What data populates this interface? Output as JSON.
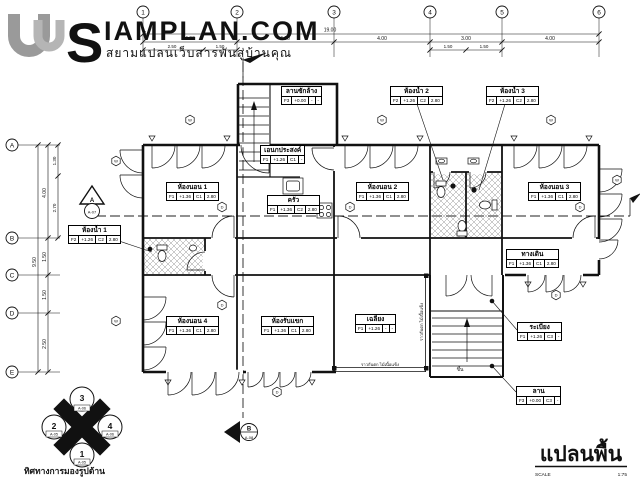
{
  "logo": {
    "brand_s": "S",
    "brand_rest": "IAMPLAN.COM",
    "tagline": "สยามแปลนเว็บสารพันสู่บ้านคุณ"
  },
  "grid": {
    "top": [
      "1",
      "2",
      "3",
      "4",
      "5",
      "6"
    ],
    "left": [
      "A",
      "B",
      "C",
      "D",
      "E"
    ]
  },
  "dimensions": {
    "top_total": "19.00",
    "top_segments": [
      "4.00",
      "4.00",
      "4.00",
      "3.00",
      "4.00"
    ],
    "top_sub_left": [
      "2.50",
      "1.50"
    ],
    "top_sub_mid": [
      "1.50",
      "1.50"
    ],
    "left_total": "9.50",
    "left_segments": [
      "4.00",
      "1.50",
      "1.50",
      "2.50"
    ],
    "left_sub": [
      "1.30",
      "2.70"
    ]
  },
  "rooms": {
    "bedroom1": {
      "name": "ห้องนอน 1",
      "floor": "F1",
      "level": "+1.36",
      "ceiling": "C1",
      "height": "2.80"
    },
    "bedroom2": {
      "name": "ห้องนอน 2",
      "floor": "F1",
      "level": "+1.36",
      "ceiling": "C1",
      "height": "2.80"
    },
    "bedroom3": {
      "name": "ห้องนอน 3",
      "floor": "F1",
      "level": "+1.36",
      "ceiling": "C1",
      "height": "2.80"
    },
    "bedroom4": {
      "name": "ห้องนอน 4",
      "floor": "F1",
      "level": "+1.36",
      "ceiling": "C1",
      "height": "2.80"
    },
    "bathroom1": {
      "name": "ห้องน้ำ 1",
      "floor": "F2",
      "level": "+1.26",
      "ceiling": "C2",
      "height": "2.80"
    },
    "bathroom2": {
      "name": "ห้องน้ำ 2",
      "floor": "F2",
      "level": "+1.26",
      "ceiling": "C2",
      "height": "2.80"
    },
    "bathroom3": {
      "name": "ห้องน้ำ 3",
      "floor": "F2",
      "level": "+1.26",
      "ceiling": "C2",
      "height": "2.80"
    },
    "kitchen": {
      "name": "ครัว",
      "floor": "F1",
      "level": "+1.36",
      "ceiling": "C2",
      "height": "2.80"
    },
    "multipurpose": {
      "name": "เอนกประสงค์",
      "floor": "F1",
      "level": "+1.26",
      "ceiling": "C1",
      "height": "-"
    },
    "washing": {
      "name": "ลานซักล้าง",
      "floor": "F3",
      "level": "+0.00",
      "ceiling": "-",
      "height": "-"
    },
    "living": {
      "name": "ห้องรับแขก",
      "floor": "F1",
      "level": "+1.36",
      "ceiling": "C1",
      "height": "2.80"
    },
    "porch": {
      "name": "เฉลียง",
      "floor": "F1",
      "level": "+1.26",
      "ceiling": "-",
      "height": "-"
    },
    "corridor": {
      "name": "ทางเดิน",
      "floor": "F1",
      "level": "+1.36",
      "ceiling": "C1",
      "height": "2.80"
    },
    "balcony": {
      "name": "ระเบียง",
      "floor": "F1",
      "level": "+1.26",
      "ceiling": "C3",
      "height": "-"
    },
    "yard": {
      "name": "ลาน",
      "floor": "F3",
      "level": "+0.00",
      "ceiling": "C3",
      "height": "-"
    }
  },
  "stairs": {
    "up_label": "ขึ้น"
  },
  "notes": {
    "railing": "ราวกันตก ไม้เนื้อแข็ง"
  },
  "markers": {
    "section_a": {
      "letter": "A",
      "sheet": "A-07"
    },
    "section_b": {
      "letter": "B",
      "sheet": "A-08"
    },
    "window_code": "W",
    "door_code": "D"
  },
  "compass": {
    "top": {
      "num": "3",
      "sheet": "A-06"
    },
    "left": {
      "num": "2",
      "sheet": "A-05"
    },
    "right": {
      "num": "4",
      "sheet": "A-06"
    },
    "bottom": {
      "num": "1",
      "sheet": "A-05"
    },
    "caption": "ทิศทางการมองรูปด้าน"
  },
  "title_block": {
    "title": "แปลนพื้น",
    "scale_label": "SCALE",
    "scale_value": "1:75"
  }
}
